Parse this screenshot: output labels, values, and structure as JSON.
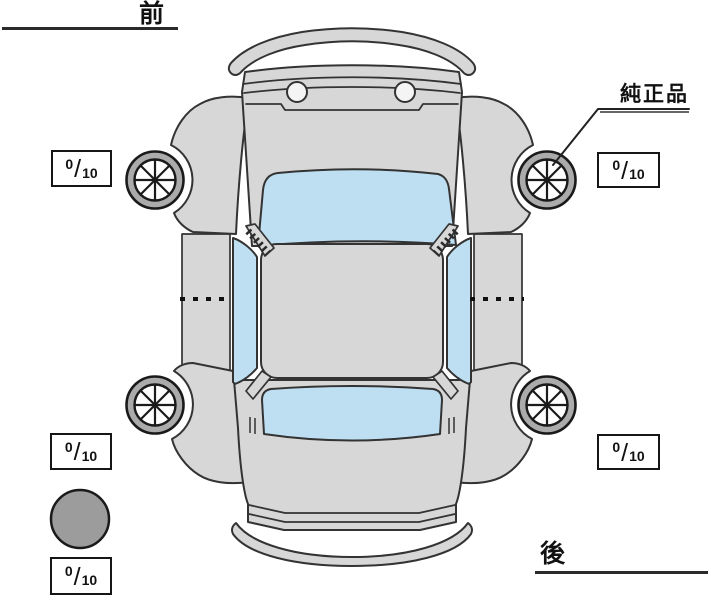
{
  "labels": {
    "front": "前",
    "rear": "後",
    "genuine_part": "純正品"
  },
  "tire_scores": {
    "front_left": {
      "value": "0",
      "max": "10"
    },
    "front_right": {
      "value": "0",
      "max": "10"
    },
    "rear_left": {
      "value": "0",
      "max": "10"
    },
    "rear_right": {
      "value": "0",
      "max": "10"
    },
    "spare": {
      "value": "0",
      "max": "10"
    }
  },
  "score_separator": "/",
  "colors": {
    "body": "#d7d7d7",
    "glass": "#bedff2",
    "outline": "#333333",
    "tire_ring": "#ababab",
    "hub": "#fefefe",
    "spare_fill": "#9c9c9c"
  }
}
